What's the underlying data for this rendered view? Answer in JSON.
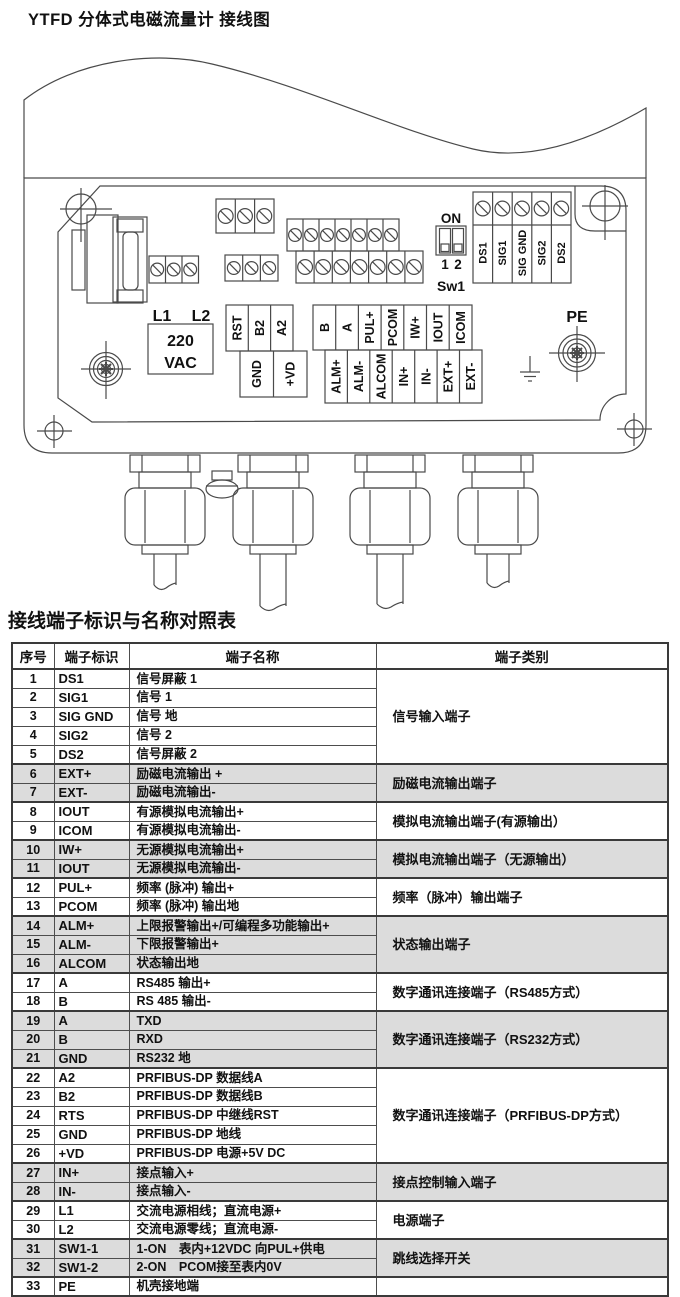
{
  "page": {
    "title": "YTFD 分体式电磁流量计 接线图"
  },
  "diagram": {
    "power": {
      "l1": "L1",
      "l2": "L2",
      "v1": "220",
      "v2": "VAC"
    },
    "dip": {
      "on": "ON",
      "p1": "1",
      "p2": "2",
      "name": "Sw1"
    },
    "profibus": {
      "rst": "RST",
      "b2": "B2",
      "a2": "A2",
      "gnd": "GND",
      "vd": "+VD"
    },
    "io_row_top": [
      "B",
      "A",
      "PUL+",
      "PCOM",
      "IW+",
      "IOUT",
      "ICOM"
    ],
    "io_row_bottom": [
      "ALM+",
      "ALM-",
      "ALCOM",
      "IN+",
      "IN-",
      "EXT+",
      "EXT-"
    ],
    "signal_block": [
      "DS1",
      "SIG1",
      "SIG GND",
      "SIG2",
      "DS2"
    ],
    "pe": "PE"
  },
  "table": {
    "title": "接线端子标识与名称对照表",
    "headers": {
      "no": "序号",
      "id": "端子标识",
      "name": "端子名称",
      "category": "端子类别"
    },
    "groups": [
      {
        "label": "信号输入端子"
      },
      {
        "label": "励磁电流输出端子"
      },
      {
        "label": "模拟电流输出端子(有源输出）"
      },
      {
        "label": "模拟电流输出端子（无源输出）"
      },
      {
        "label": "频率（脉冲）输出端子"
      },
      {
        "label": "状态输出端子"
      },
      {
        "label": "数字通讯连接端子（RS485方式）"
      },
      {
        "label": "数字通讯连接端子（RS232方式）"
      },
      {
        "label": "数字通讯连接端子（PRFIBUS-DP方式）"
      },
      {
        "label": "接点控制输入端子"
      },
      {
        "label": "电源端子"
      },
      {
        "label": "跳线选择开关"
      },
      {
        "label": ""
      }
    ],
    "rows": [
      {
        "no": "1",
        "id": "DS1",
        "name": "信号屏蔽 1"
      },
      {
        "no": "2",
        "id": "SIG1",
        "name": "信号 1"
      },
      {
        "no": "3",
        "id": "SIG GND",
        "name": "信号 地"
      },
      {
        "no": "4",
        "id": "SIG2",
        "name": "信号 2"
      },
      {
        "no": "5",
        "id": "DS2",
        "name": "信号屏蔽 2"
      },
      {
        "no": "6",
        "id": "EXT+",
        "name": "励磁电流输出 +"
      },
      {
        "no": "7",
        "id": "EXT-",
        "name": "励磁电流输出-"
      },
      {
        "no": "8",
        "id": "IOUT",
        "name": "有源模拟电流输出+"
      },
      {
        "no": "9",
        "id": "ICOM",
        "name": "有源模拟电流输出-"
      },
      {
        "no": "10",
        "id": "IW+",
        "name": "无源模拟电流输出+"
      },
      {
        "no": "11",
        "id": "IOUT",
        "name": "无源模拟电流输出-"
      },
      {
        "no": "12",
        "id": "PUL+",
        "name": "频率 (脉冲) 输出+"
      },
      {
        "no": "13",
        "id": "PCOM",
        "name": "频率 (脉冲) 输出地"
      },
      {
        "no": "14",
        "id": "ALM+",
        "name": "上限报警输出+/可编程多功能输出+"
      },
      {
        "no": "15",
        "id": "ALM-",
        "name": "下限报警输出+"
      },
      {
        "no": "16",
        "id": "ALCOM",
        "name": "状态输出地"
      },
      {
        "no": "17",
        "id": "A",
        "name": "RS485 输出+"
      },
      {
        "no": "18",
        "id": "B",
        "name": "RS 485 输出-"
      },
      {
        "no": "19",
        "id": "A",
        "name": "TXD"
      },
      {
        "no": "20",
        "id": "B",
        "name": "RXD"
      },
      {
        "no": "21",
        "id": "GND",
        "name": "RS232 地"
      },
      {
        "no": "22",
        "id": "A2",
        "name": "PRFIBUS-DP 数据线A"
      },
      {
        "no": "23",
        "id": "B2",
        "name": "PRFIBUS-DP 数据线B"
      },
      {
        "no": "24",
        "id": "RTS",
        "name": "PRFIBUS-DP 中继线RST"
      },
      {
        "no": "25",
        "id": "GND",
        "name": "PRFIBUS-DP 地线"
      },
      {
        "no": "26",
        "id": "+VD",
        "name": "PRFIBUS-DP 电源+5V DC"
      },
      {
        "no": "27",
        "id": "IN+",
        "name": "接点输入+"
      },
      {
        "no": "28",
        "id": "IN-",
        "name": "接点输入-"
      },
      {
        "no": "29",
        "id": "L1",
        "name": "交流电源相线；直流电源+"
      },
      {
        "no": "30",
        "id": "L2",
        "name": "交流电源零线；直流电源-"
      },
      {
        "no": "31",
        "id": "SW1-1",
        "name": "1-ON　表内+12VDC 向PUL+供电"
      },
      {
        "no": "32",
        "id": "SW1-2",
        "name": "2-ON　PCOM接至表内0V"
      },
      {
        "no": "33",
        "id": "PE",
        "name": "机壳接地端"
      }
    ]
  }
}
